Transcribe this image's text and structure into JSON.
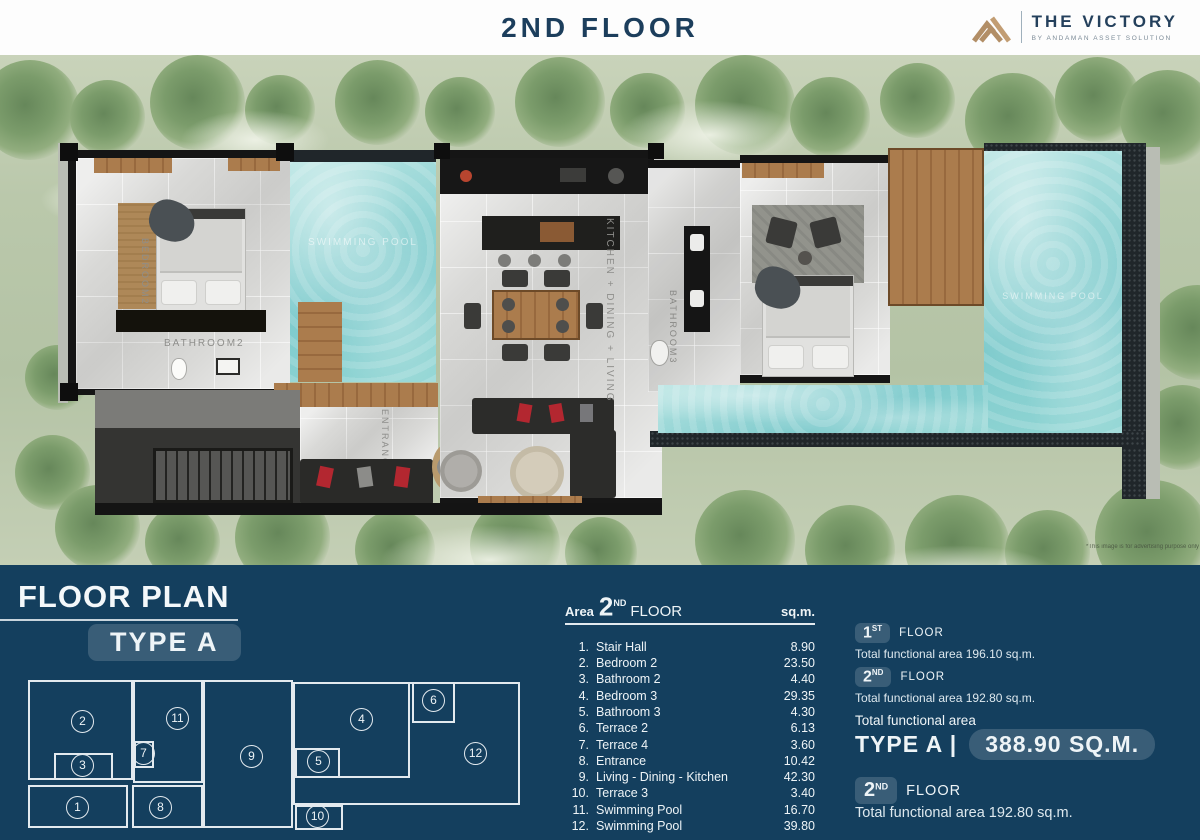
{
  "header": {
    "title": "2ND FLOOR",
    "logo": {
      "name": "THE VICTORY",
      "tagline": "BY ANDAMAN ASSET SOLUTION"
    }
  },
  "plan": {
    "labels": {
      "bedroom2": "BEDROOM2",
      "bathroom2": "BATHROOM2",
      "kitchen_dining_living": "KITCHEN  +  DINING  +  LIVING",
      "bathroom3": "BATHROOM3",
      "entrance": "ENTRANCE",
      "pool": "SWIMMING POOL"
    },
    "disclaimer": "*This image is for advertising purpose only"
  },
  "panel": {
    "section_title": "FLOOR PLAN",
    "type_badge": "TYPE A",
    "diagram": {
      "numbers": [
        "1",
        "2",
        "3",
        "4",
        "5",
        "6",
        "7",
        "8",
        "9",
        "10",
        "11",
        "12"
      ]
    },
    "table": {
      "header": {
        "area_label": "Area",
        "floor_number": "2",
        "floor_ordinal": "ND",
        "floor_label": "FLOOR",
        "unit": "sq.m."
      },
      "rows": [
        {
          "no": "1.",
          "name": "Stair Hall",
          "area": "8.90"
        },
        {
          "no": "2.",
          "name": "Bedroom 2",
          "area": "23.50"
        },
        {
          "no": "3.",
          "name": "Bathroom 2",
          "area": "4.40"
        },
        {
          "no": "4.",
          "name": "Bedroom 3",
          "area": "29.35"
        },
        {
          "no": "5.",
          "name": "Bathroom 3",
          "area": "4.30"
        },
        {
          "no": "6.",
          "name": "Terrace 2",
          "area": "6.13"
        },
        {
          "no": "7.",
          "name": "Terrace 4",
          "area": "3.60"
        },
        {
          "no": "8.",
          "name": "Entrance",
          "area": "10.42"
        },
        {
          "no": "9.",
          "name": "Living - Dining - Kitchen",
          "area": "42.30"
        },
        {
          "no": "10.",
          "name": "Terrace 3",
          "area": "3.40"
        },
        {
          "no": "11.",
          "name": "Swimming Pool",
          "area": "16.70"
        },
        {
          "no": "12.",
          "name": "Swimming Pool",
          "area": "39.80"
        }
      ]
    },
    "summary": {
      "floors": [
        {
          "num": "1",
          "ord": "ST",
          "label": "FLOOR",
          "detail": "Total functional area 196.10 sq.m."
        },
        {
          "num": "2",
          "ord": "ND",
          "label": "FLOOR",
          "detail": "Total functional area 192.80 sq.m."
        }
      ],
      "total_label": "Total functional area",
      "total_type": "TYPE A |",
      "total_value": "388.90 SQ.M.",
      "bottom": {
        "num": "2",
        "ord": "ND",
        "label": "FLOOR",
        "detail": "Total functional area 192.80 sq.m."
      }
    }
  },
  "colors": {
    "panel_navy": "#143f5e",
    "title_navy": "#1c3e5c",
    "brand_tan": "#b28e66",
    "pool_cyan": "#7fcbcd",
    "landscape_green": "#b4c3a5"
  }
}
